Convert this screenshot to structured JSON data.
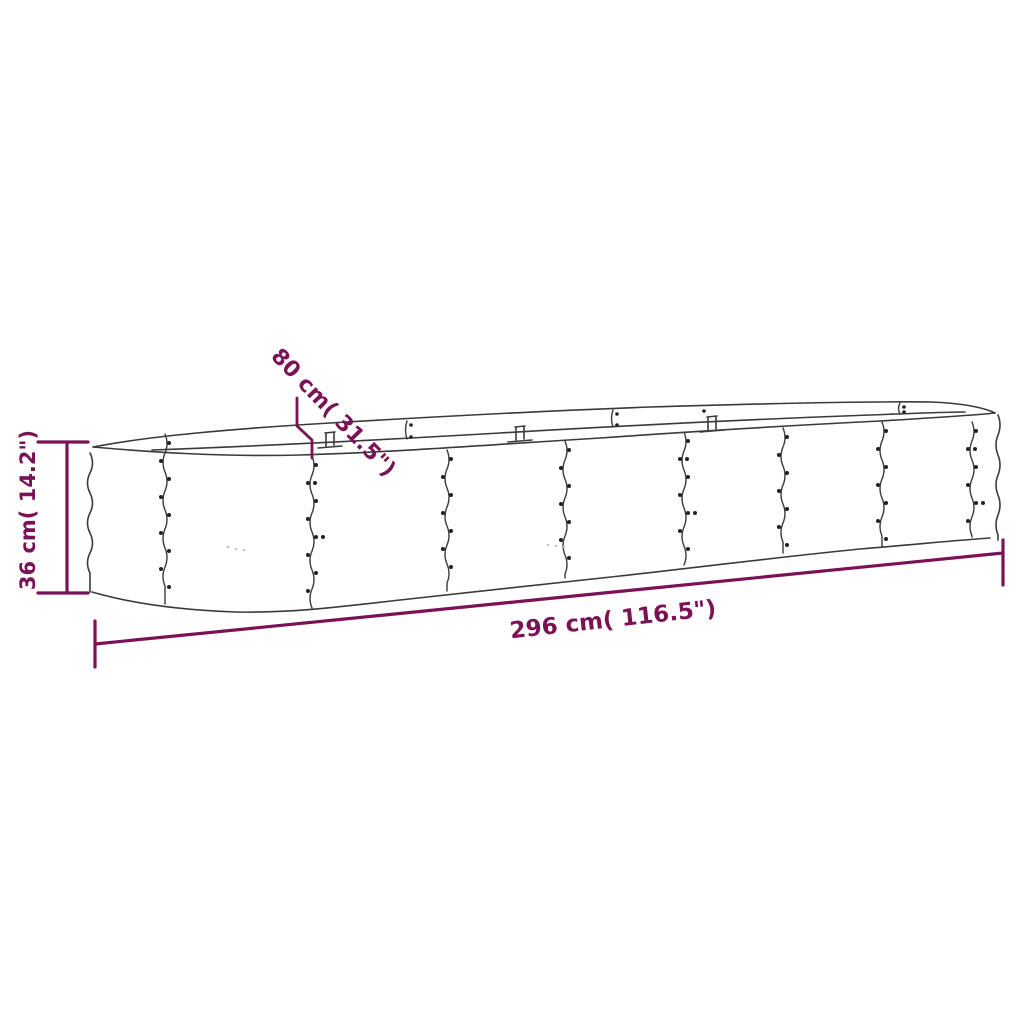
{
  "diagram": {
    "accent_color": "#7a1355",
    "line_color": "#3a3a3a",
    "background_color": "#ffffff",
    "labels": {
      "length": "296 cm( 116.5\")",
      "width": "80 cm( 31.5\")",
      "height": "36 cm( 14.2\")"
    }
  }
}
